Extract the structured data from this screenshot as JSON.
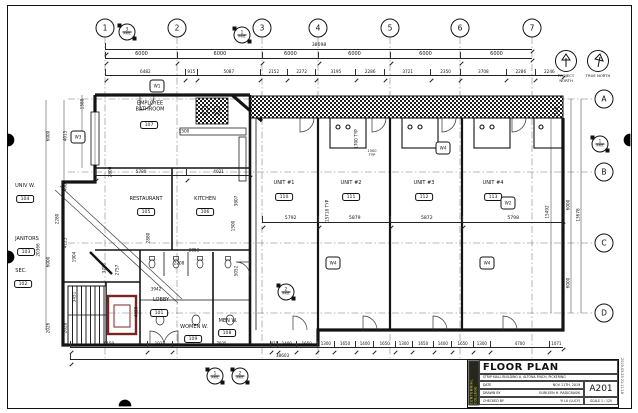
{
  "sheet": {
    "title": "FLOOR PLAN",
    "subtitle": "STRIP MALL BUILDING A, ALTONA-FINCH, PICKERING",
    "fields": [
      {
        "label": "DATE",
        "value": "NOV 11TH, 2019"
      },
      {
        "label": "DRAWN BY",
        "value": "GURLEEN H. RADICBASIK"
      },
      {
        "label": "CHECKED BY",
        "value": "YI LU (LUCY)"
      }
    ],
    "number": "A201",
    "scale": "SCALE 1 : 125",
    "logo": "CENTENNIAL COLLEGE",
    "stamp": "2019-03-23 21:11:18"
  },
  "grid": {
    "columns": [
      "1",
      "2",
      "3",
      "4",
      "5",
      "6",
      "7"
    ],
    "rows": [
      "A",
      "B",
      "C",
      "D"
    ]
  },
  "north": {
    "project": "PROJECT NORTH",
    "true": "TRUE NORTH"
  },
  "rooms": [
    {
      "name": "EMPLOYEE BATHROOM",
      "tag": "107"
    },
    {
      "name": "RESTAURANT",
      "tag": "105"
    },
    {
      "name": "KITCHEN",
      "tag": "106"
    },
    {
      "name": "UNIV W.",
      "tag": "104"
    },
    {
      "name": "JANITORS",
      "tag": "103"
    },
    {
      "name": "SEC.",
      "tag": "102"
    },
    {
      "name": "LOBBY",
      "tag": "101"
    },
    {
      "name": "WOMEN W.",
      "tag": "109"
    },
    {
      "name": "MEN W.",
      "tag": "108"
    }
  ],
  "units": [
    {
      "name": "UNIT #1",
      "tag": "110",
      "width": "5792"
    },
    {
      "name": "UNIT #2",
      "tag": "111",
      "width": "5879"
    },
    {
      "name": "UNIT #3",
      "tag": "112",
      "width": "5872"
    },
    {
      "name": "UNIT #4",
      "tag": "113",
      "width": "5798"
    }
  ],
  "dims": {
    "top_total": "38698",
    "top_equal": [
      "6000",
      "6000",
      "6000",
      "6000",
      "6000",
      "6000"
    ],
    "top_detail": [
      "6482",
      "915",
      "5087",
      "2152",
      "2272",
      "3195",
      "2286",
      "3721",
      "2350",
      "3708",
      "2286",
      "2246"
    ],
    "restaurant_row": [
      "5780",
      "4021"
    ],
    "bottom_detail": [
      "6159",
      "1922",
      "7925",
      "475",
      "1400",
      "1650",
      "1300",
      "1650",
      "1400",
      "1650",
      "1300",
      "1650",
      "1400",
      "1650",
      "1300",
      "4700",
      "1071"
    ],
    "bottom_total": "38603",
    "left": [
      "1580",
      "6000",
      "4015",
      "4005",
      "2280",
      "20366",
      "4125",
      "1904",
      "6000",
      "3451",
      "2026",
      "2028"
    ],
    "right": [
      "2186",
      "15492",
      "6000",
      "13678",
      "6000"
    ],
    "interior": [
      "1500",
      "2800",
      "3807",
      "1500",
      "5052",
      "2853",
      "2208",
      "3942",
      "3781",
      "2757",
      "4323",
      "2880",
      "15718 TYP",
      "1700 TYP",
      "1500 TYP"
    ]
  },
  "markers": {
    "w": [
      "W1",
      "W3",
      "W4",
      "W2",
      "W4",
      "W4"
    ],
    "sections": [
      {
        "num": "3",
        "ref": "A401"
      },
      {
        "num": "1",
        "ref": "A401"
      },
      {
        "num": "2",
        "ref": "A401"
      },
      {
        "num": "1",
        "ref": "A401"
      },
      {
        "num": "2",
        "ref": "A401"
      },
      {
        "num": "1",
        "ref": "A401"
      }
    ]
  }
}
